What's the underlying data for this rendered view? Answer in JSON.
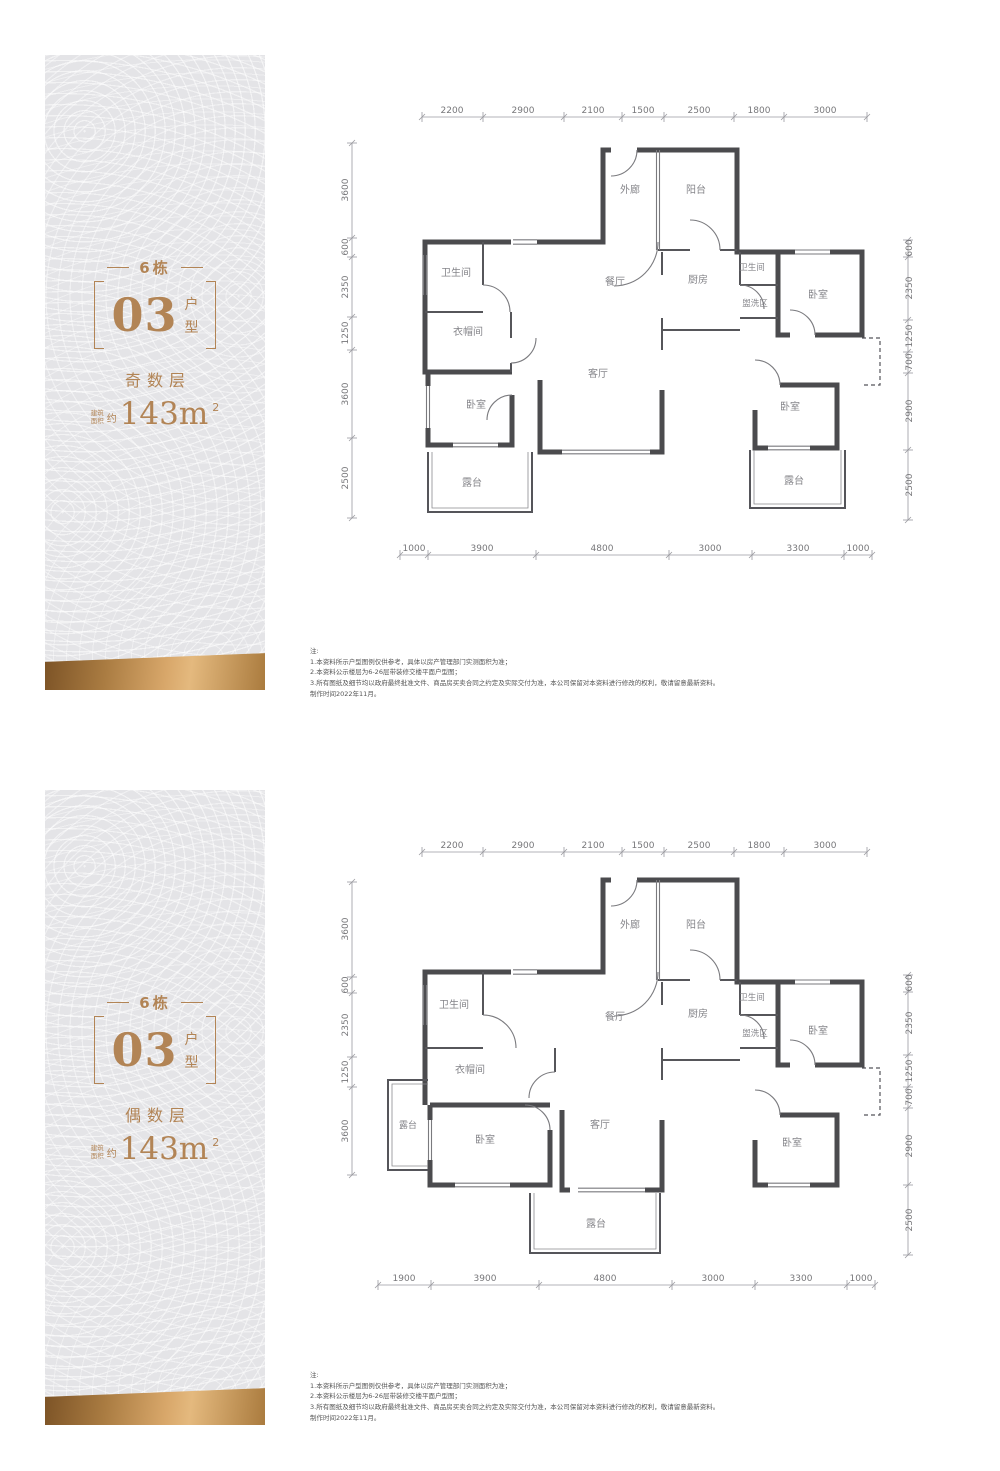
{
  "colors": {
    "accent": "#b28455",
    "wall": "#4b4b4e",
    "panel_bg": "#e4e4e7",
    "band_gold": "#d8a76a"
  },
  "panels": {
    "odd": {
      "building": "6栋",
      "unit": "03",
      "unit_char1": "户",
      "unit_char2": "型",
      "floor": "奇数层",
      "area_label1": "建筑",
      "area_label2": "面积",
      "area_approx": "约",
      "area_value": "143m",
      "area_exp": "2"
    },
    "even": {
      "building": "6栋",
      "unit": "03",
      "unit_char1": "户",
      "unit_char2": "型",
      "floor": "偶数层",
      "area_label1": "建筑",
      "area_label2": "面积",
      "area_approx": "约",
      "area_value": "143m",
      "area_exp": "2"
    }
  },
  "plans": {
    "odd": {
      "rooms": [
        "外廊",
        "阳台",
        "卫生间",
        "衣帽间",
        "餐厅",
        "厨房",
        "卫生间",
        "盥洗区",
        "卧室",
        "卧室",
        "客厅",
        "卧室",
        "露台",
        "露台"
      ],
      "dims_top": [
        "2200",
        "2900",
        "2100",
        "1500",
        "2500",
        "1800",
        "3000"
      ],
      "dims_bottom": [
        "1000",
        "3900",
        "4800",
        "3000",
        "3300",
        "1000"
      ],
      "dims_left": [
        "3600",
        "600",
        "2350",
        "1250",
        "3600",
        "2500"
      ],
      "dims_right": [
        "600",
        "2350",
        "1250",
        "700",
        "2900",
        "2500"
      ]
    },
    "even": {
      "rooms": [
        "外廊",
        "阳台",
        "卫生间",
        "餐厅",
        "厨房",
        "卫生间",
        "盥洗区",
        "卧室",
        "衣帽间",
        "露台",
        "卧室",
        "客厅",
        "卧室",
        "露台"
      ],
      "dims_top": [
        "2200",
        "2900",
        "2100",
        "1500",
        "2500",
        "1800",
        "3000"
      ],
      "dims_bottom": [
        "1900",
        "3900",
        "4800",
        "3000",
        "3300",
        "1000"
      ],
      "dims_left": [
        "3600",
        "600",
        "2350",
        "1250",
        "3600"
      ],
      "dims_right": [
        "600",
        "2350",
        "1250",
        "700",
        "2900",
        "2500"
      ]
    }
  },
  "notes": {
    "title": "注:",
    "l1": "1.本资料所示户型图例仅供参考，具体以房产管理部门实测面积为准；",
    "l2": "2.本资料公示楼层为6-26层带装修交楼平面户型图；",
    "l3": "3.所有图纸及细节均以政府最终批准文件、商品房买卖合同之约定及实际交付为准，本公司保留对本资料进行修改的权利，敬请留意最新资料。",
    "l4": "制作时间2022年11月。"
  }
}
